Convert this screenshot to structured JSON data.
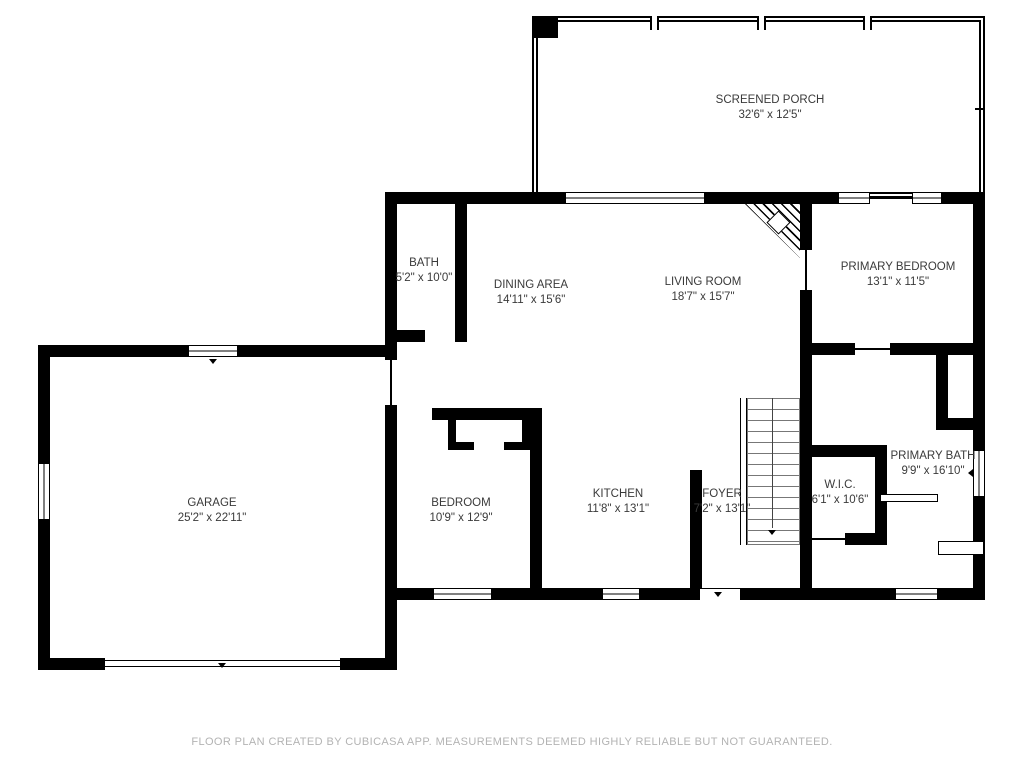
{
  "rooms": [
    {
      "name": "SCREENED PORCH",
      "dims": "32'6\" x 12'5\""
    },
    {
      "name": "BATH",
      "dims": "5'2\" x 10'0\""
    },
    {
      "name": "DINING AREA",
      "dims": "14'11\" x 15'6\""
    },
    {
      "name": "LIVING ROOM",
      "dims": "18'7\" x 15'7\""
    },
    {
      "name": "PRIMARY BEDROOM",
      "dims": "13'1\" x 11'5\""
    },
    {
      "name": "GARAGE",
      "dims": "25'2\" x 22'11\""
    },
    {
      "name": "BEDROOM",
      "dims": "10'9\" x 12'9\""
    },
    {
      "name": "KITCHEN",
      "dims": "11'8\" x 13'1\""
    },
    {
      "name": "FOYER",
      "dims": "7'2\" x 13'1\""
    },
    {
      "name": "W.I.C.",
      "dims": "6'1\" x 10'6\""
    },
    {
      "name": "PRIMARY BATH",
      "dims": "9'9\" x 16'10\""
    }
  ],
  "footer": {
    "disclaimer": "FLOOR PLAN CREATED BY CUBICASA APP. MEASUREMENTS DEEMED HIGHLY RELIABLE BUT NOT GUARANTEED."
  },
  "colors": {
    "wall": "#000000",
    "room_text": "#3a3a3a",
    "footer_text": "#b3b3b3"
  }
}
